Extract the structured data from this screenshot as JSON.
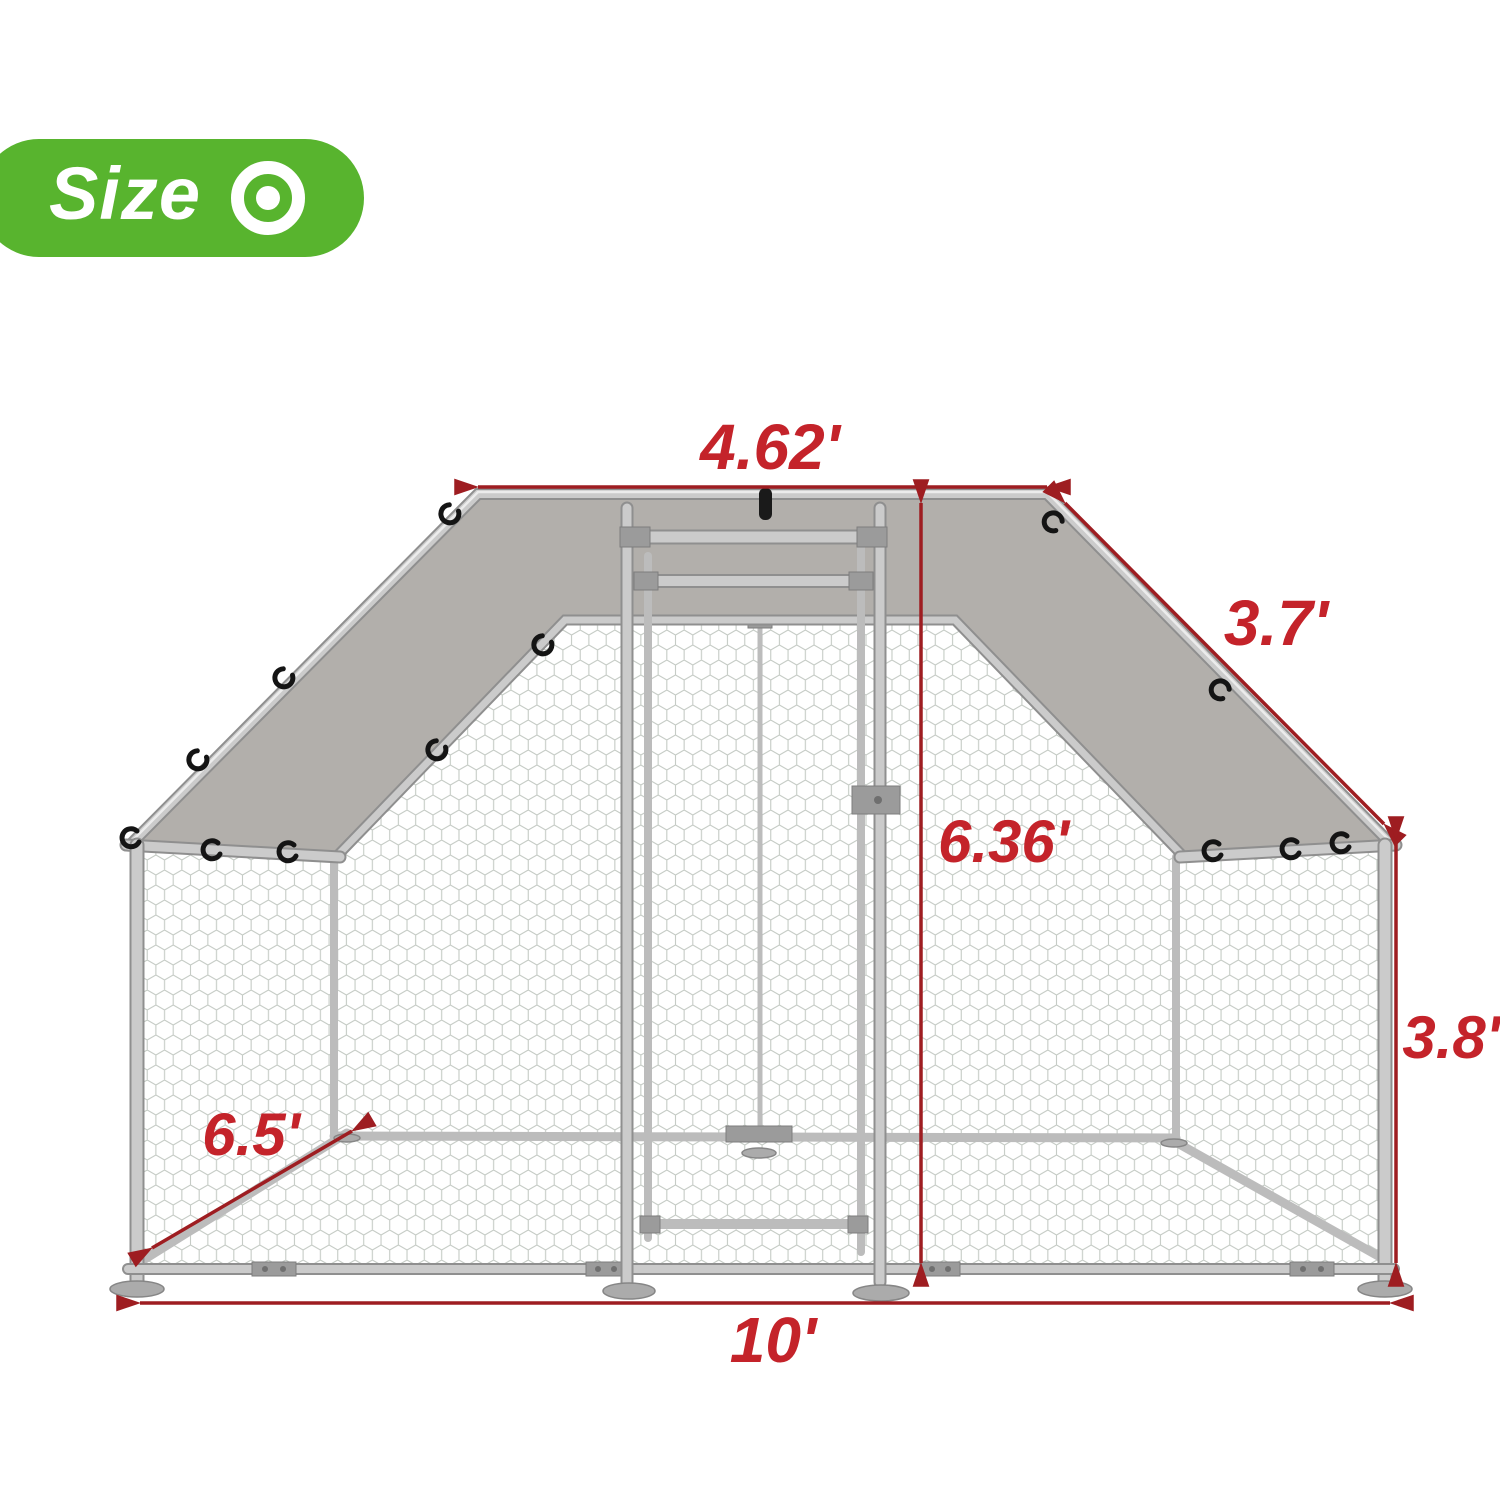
{
  "badge": {
    "label": "Size",
    "icon": "target-icon",
    "bg_color": "#58b42e"
  },
  "dimensions": {
    "top_width": "4.62'",
    "roof_slope": "3.7'",
    "door_height": "6.36'",
    "side_height": "3.8'",
    "depth": "6.5'",
    "bottom_width": "10'"
  },
  "colors": {
    "dimension_line": "#9e1d21",
    "dimension_label": "#c4232a",
    "tarp_cover": "#b2afab",
    "frame_metal": "#cbcbcb",
    "mesh_wire": "#c5cbc5",
    "badge_green": "#58b42e"
  },
  "subject": "walk-in metal chicken run cage with tarp roof cover"
}
